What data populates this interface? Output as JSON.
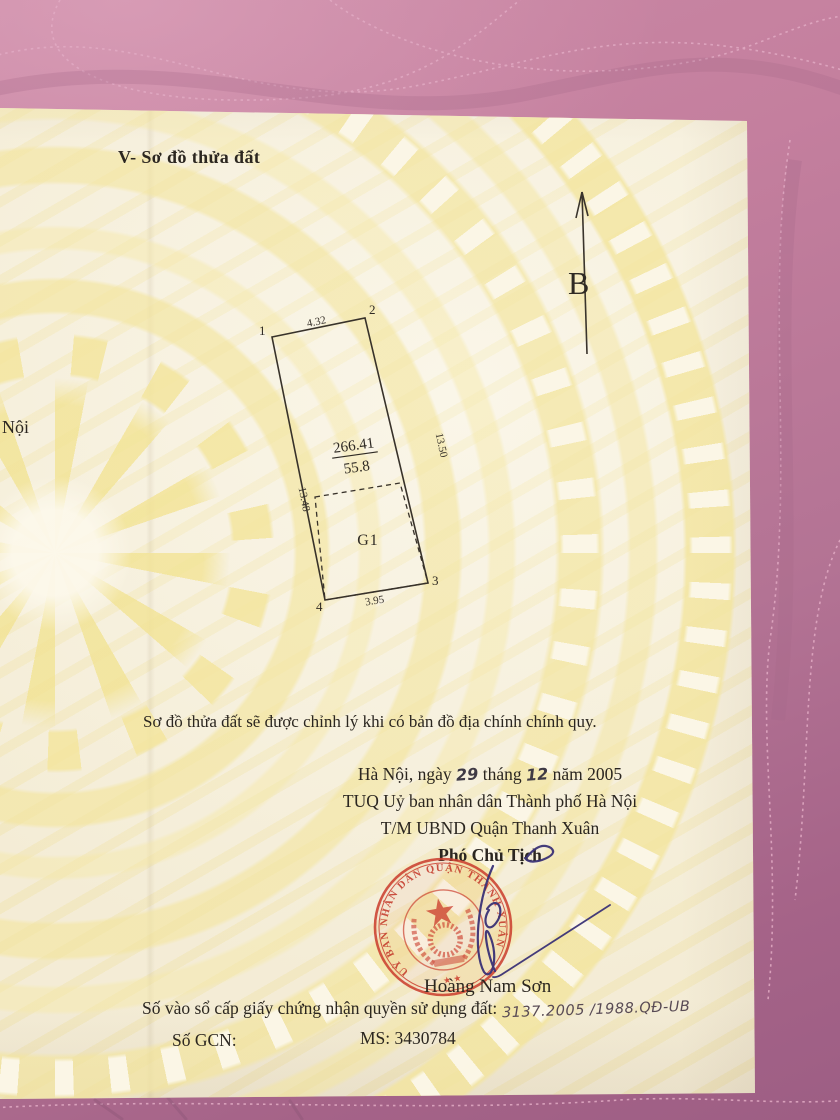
{
  "doc": {
    "section_title": "V- Sơ đồ thửa đất",
    "left_fragment": "Nội",
    "north_label": "B",
    "diagram": {
      "corner1": "1",
      "corner2": "2",
      "corner3": "3",
      "corner4": "4",
      "edge_top": "4.32",
      "edge_right": "13.50",
      "edge_left": "13.48",
      "edge_bottom": "3.95",
      "area_numerator": "266.41",
      "area_denominator": "55.8",
      "subplot": "G1"
    },
    "note": "Sơ đồ thửa đất sẽ được chỉnh lý khi có bản đồ địa chính chính quy.",
    "date": {
      "prefix": "Hà Nội, ngày",
      "day": "29",
      "middle": "tháng",
      "month": "12",
      "suffix": "năm 2005"
    },
    "authority_line1": "TUQ Uỷ ban nhân dân Thành phố Hà Nội",
    "authority_line2": "T/M UBND Quận Thanh Xuân",
    "signer_title": "Phó Chủ Tịch",
    "signer_name": "Hoàng Nam Sơn",
    "stamp_text": "UỶ BAN NHÂN DÂN QUẬN THANH XUÂN",
    "registry_label": "Số vào sổ cấp giấy chứng nhận quyền sử dụng đất:",
    "registry_value": "3137.2005 /1988.QĐ-UB",
    "gcn_label": "Số GCN:",
    "ms_value": "MS: 3430784"
  },
  "colors": {
    "fabric_pink": "#b87b99",
    "paper_cream": "#f8f2df",
    "pattern_yellow": "#f3e59e",
    "ink_black": "#2b2620",
    "stamp_red": "#c4392a",
    "signature_blue": "#3a3176"
  }
}
